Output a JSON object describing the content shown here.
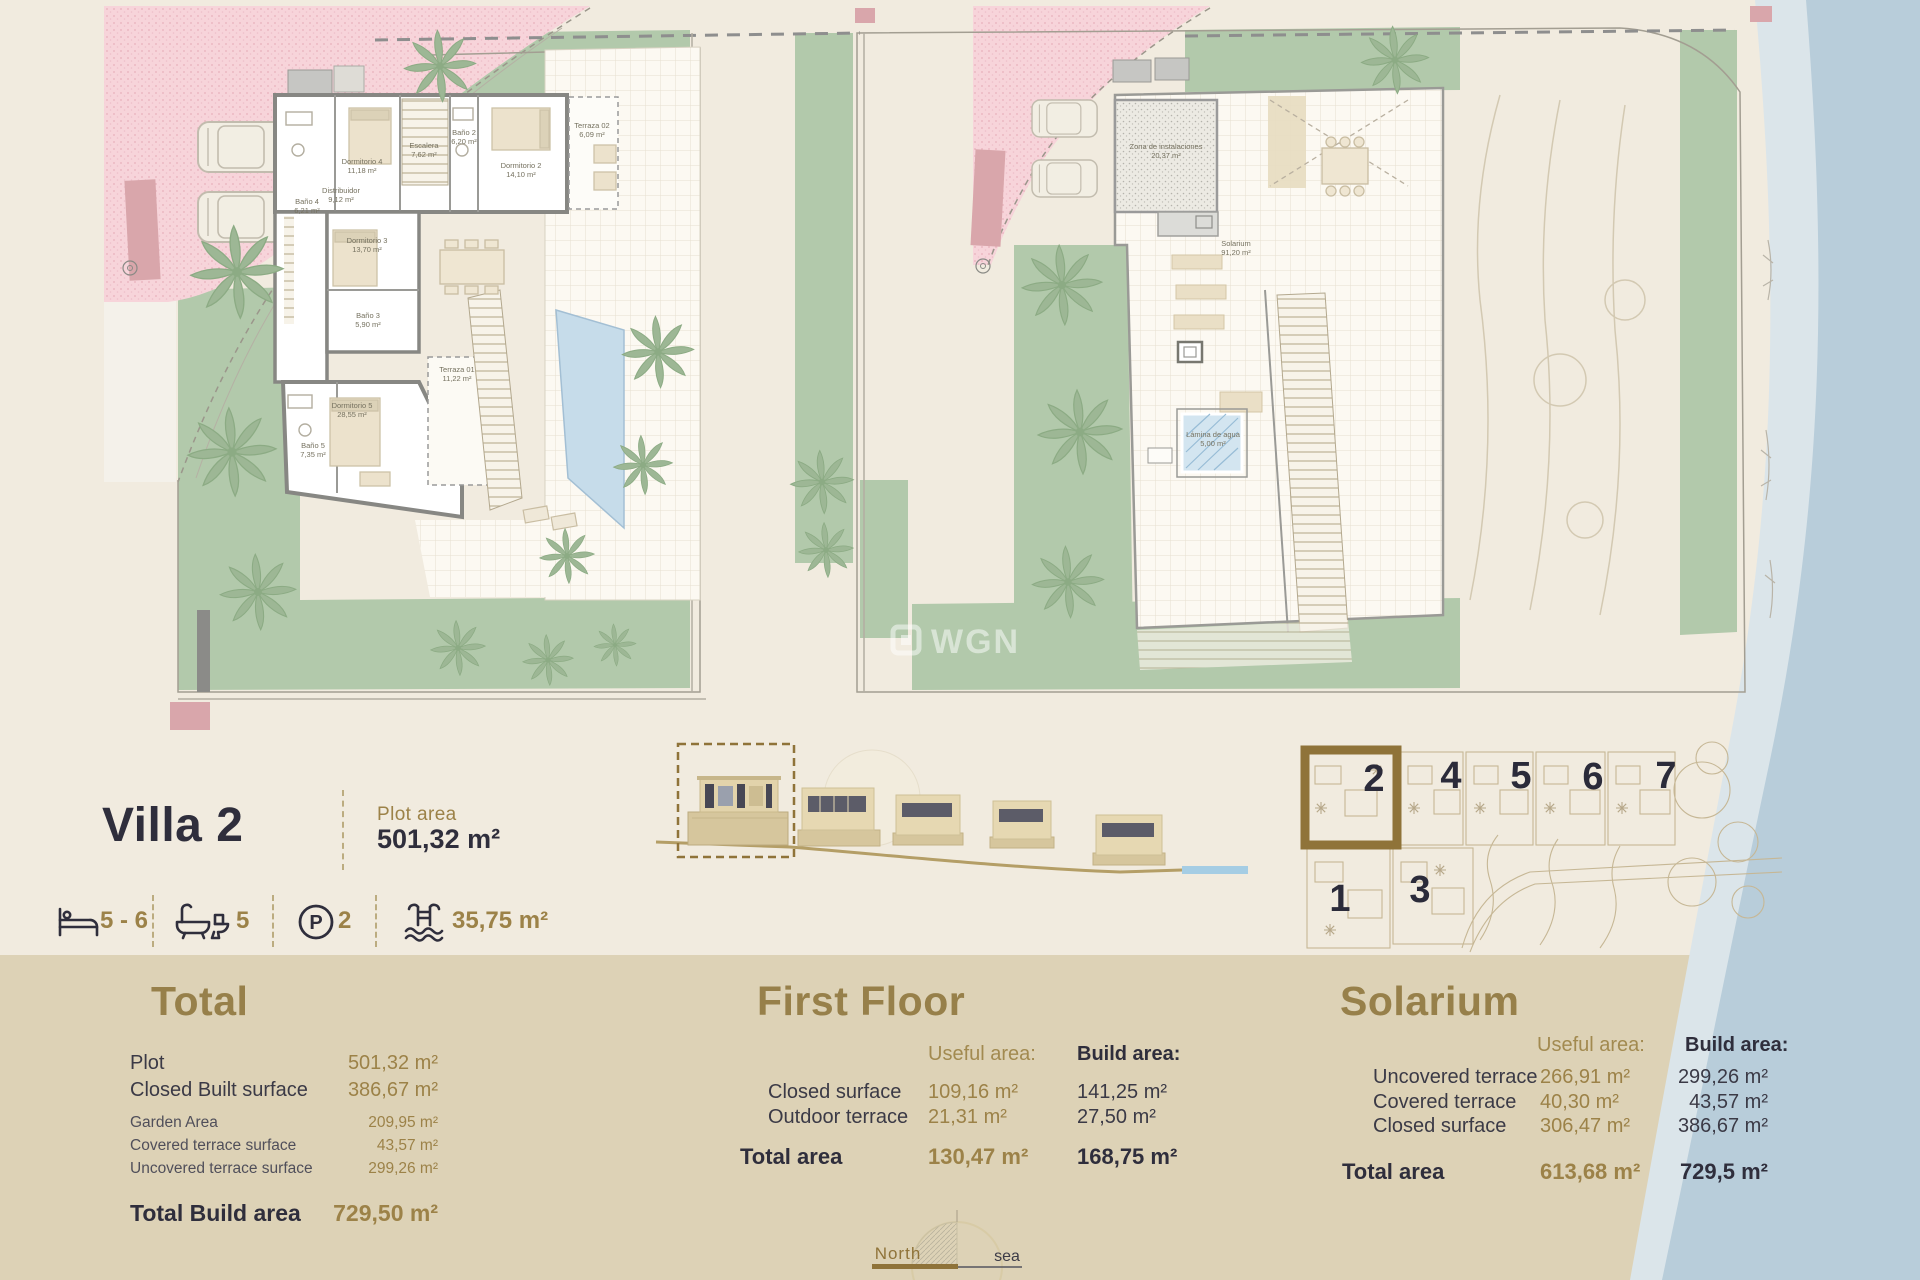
{
  "page": {
    "background": "#f1ebdf",
    "band_color": "#ddd2b6",
    "sea_color": "#b8cdda",
    "accent_gold": "#9c8248",
    "ink": "#2f2e3c",
    "garden_green": "#b2c9ab"
  },
  "header": {
    "title": "Villa 2",
    "plot_area_label": "Plot area",
    "plot_area_value": "501,32 m²"
  },
  "features": {
    "beds": "5 - 6",
    "baths": "5",
    "parking": "2",
    "parking_symbol": "P",
    "pool_area": "35,75 m²"
  },
  "watermark": {
    "text": "WGN"
  },
  "compass": {
    "north_label": "North",
    "sea_label": "sea"
  },
  "site_plan": {
    "villas": [
      "1",
      "2",
      "3",
      "4",
      "5",
      "6",
      "7"
    ],
    "highlighted": "2"
  },
  "floorplans": {
    "first_floor": {
      "rooms": [
        {
          "name": "Baño 4",
          "area": "6,21 m²"
        },
        {
          "name": "Dormitorio 4",
          "area": "11,18 m²"
        },
        {
          "name": "Escalera",
          "area": "7,62 m²"
        },
        {
          "name": "Baño 2",
          "area": "6,20 m²"
        },
        {
          "name": "Dormitorio 2",
          "area": "14,10 m²"
        },
        {
          "name": "Terraza 02",
          "area": "6,09 m²"
        },
        {
          "name": "Distribuidor",
          "area": "9,12 m²"
        },
        {
          "name": "Dormitorio 3",
          "area": "13,70 m²"
        },
        {
          "name": "Baño 3",
          "area": "5,90 m²"
        },
        {
          "name": "Dormitorio 5",
          "area": "28,55 m²"
        },
        {
          "name": "Baño 5",
          "area": "7,35 m²"
        },
        {
          "name": "Terraza 01",
          "area": "11,22 m²"
        }
      ]
    },
    "solarium": {
      "rooms": [
        {
          "name": "Zona de instalaciones",
          "area": "20,37 m²"
        },
        {
          "name": "Solarium",
          "area": "91,20 m²"
        },
        {
          "name": "Lámina de agua",
          "area": "5,00 m²"
        }
      ]
    }
  },
  "sections": {
    "total": {
      "title": "Total",
      "rows": [
        {
          "label": "Plot",
          "value": "501,32 m²"
        },
        {
          "label": "Closed Built surface",
          "value": "386,67 m²"
        },
        {
          "label": "Garden Area",
          "value": "209,95 m²"
        },
        {
          "label": "Covered terrace surface",
          "value": "43,57 m²"
        },
        {
          "label": "Uncovered terrace surface",
          "value": "299,26 m²"
        }
      ],
      "total_label": "Total Build area",
      "total_value": "729,50 m²"
    },
    "first_floor": {
      "title": "First Floor",
      "useful_header": "Useful area:",
      "build_header": "Build area:",
      "rows": [
        {
          "label": "Closed surface",
          "useful": "109,16 m²",
          "build": "141,25 m²"
        },
        {
          "label": "Outdoor terrace",
          "useful": "21,31 m²",
          "build": "27,50 m²"
        }
      ],
      "total_label": "Total area",
      "total_useful": "130,47 m²",
      "total_build": "168,75 m²"
    },
    "solarium": {
      "title": "Solarium",
      "useful_header": "Useful area:",
      "build_header": "Build area:",
      "rows": [
        {
          "label": "Uncovered terrace",
          "useful": "266,91 m²",
          "build": "299,26 m²"
        },
        {
          "label": "Covered terrace",
          "useful": "40,30 m²",
          "build": "43,57 m²"
        },
        {
          "label": "Closed surface",
          "useful": "306,47 m²",
          "build": "386,67 m²"
        }
      ],
      "total_label": "Total area",
      "total_useful": "613,68 m²",
      "total_build": "729,5 m²"
    }
  }
}
